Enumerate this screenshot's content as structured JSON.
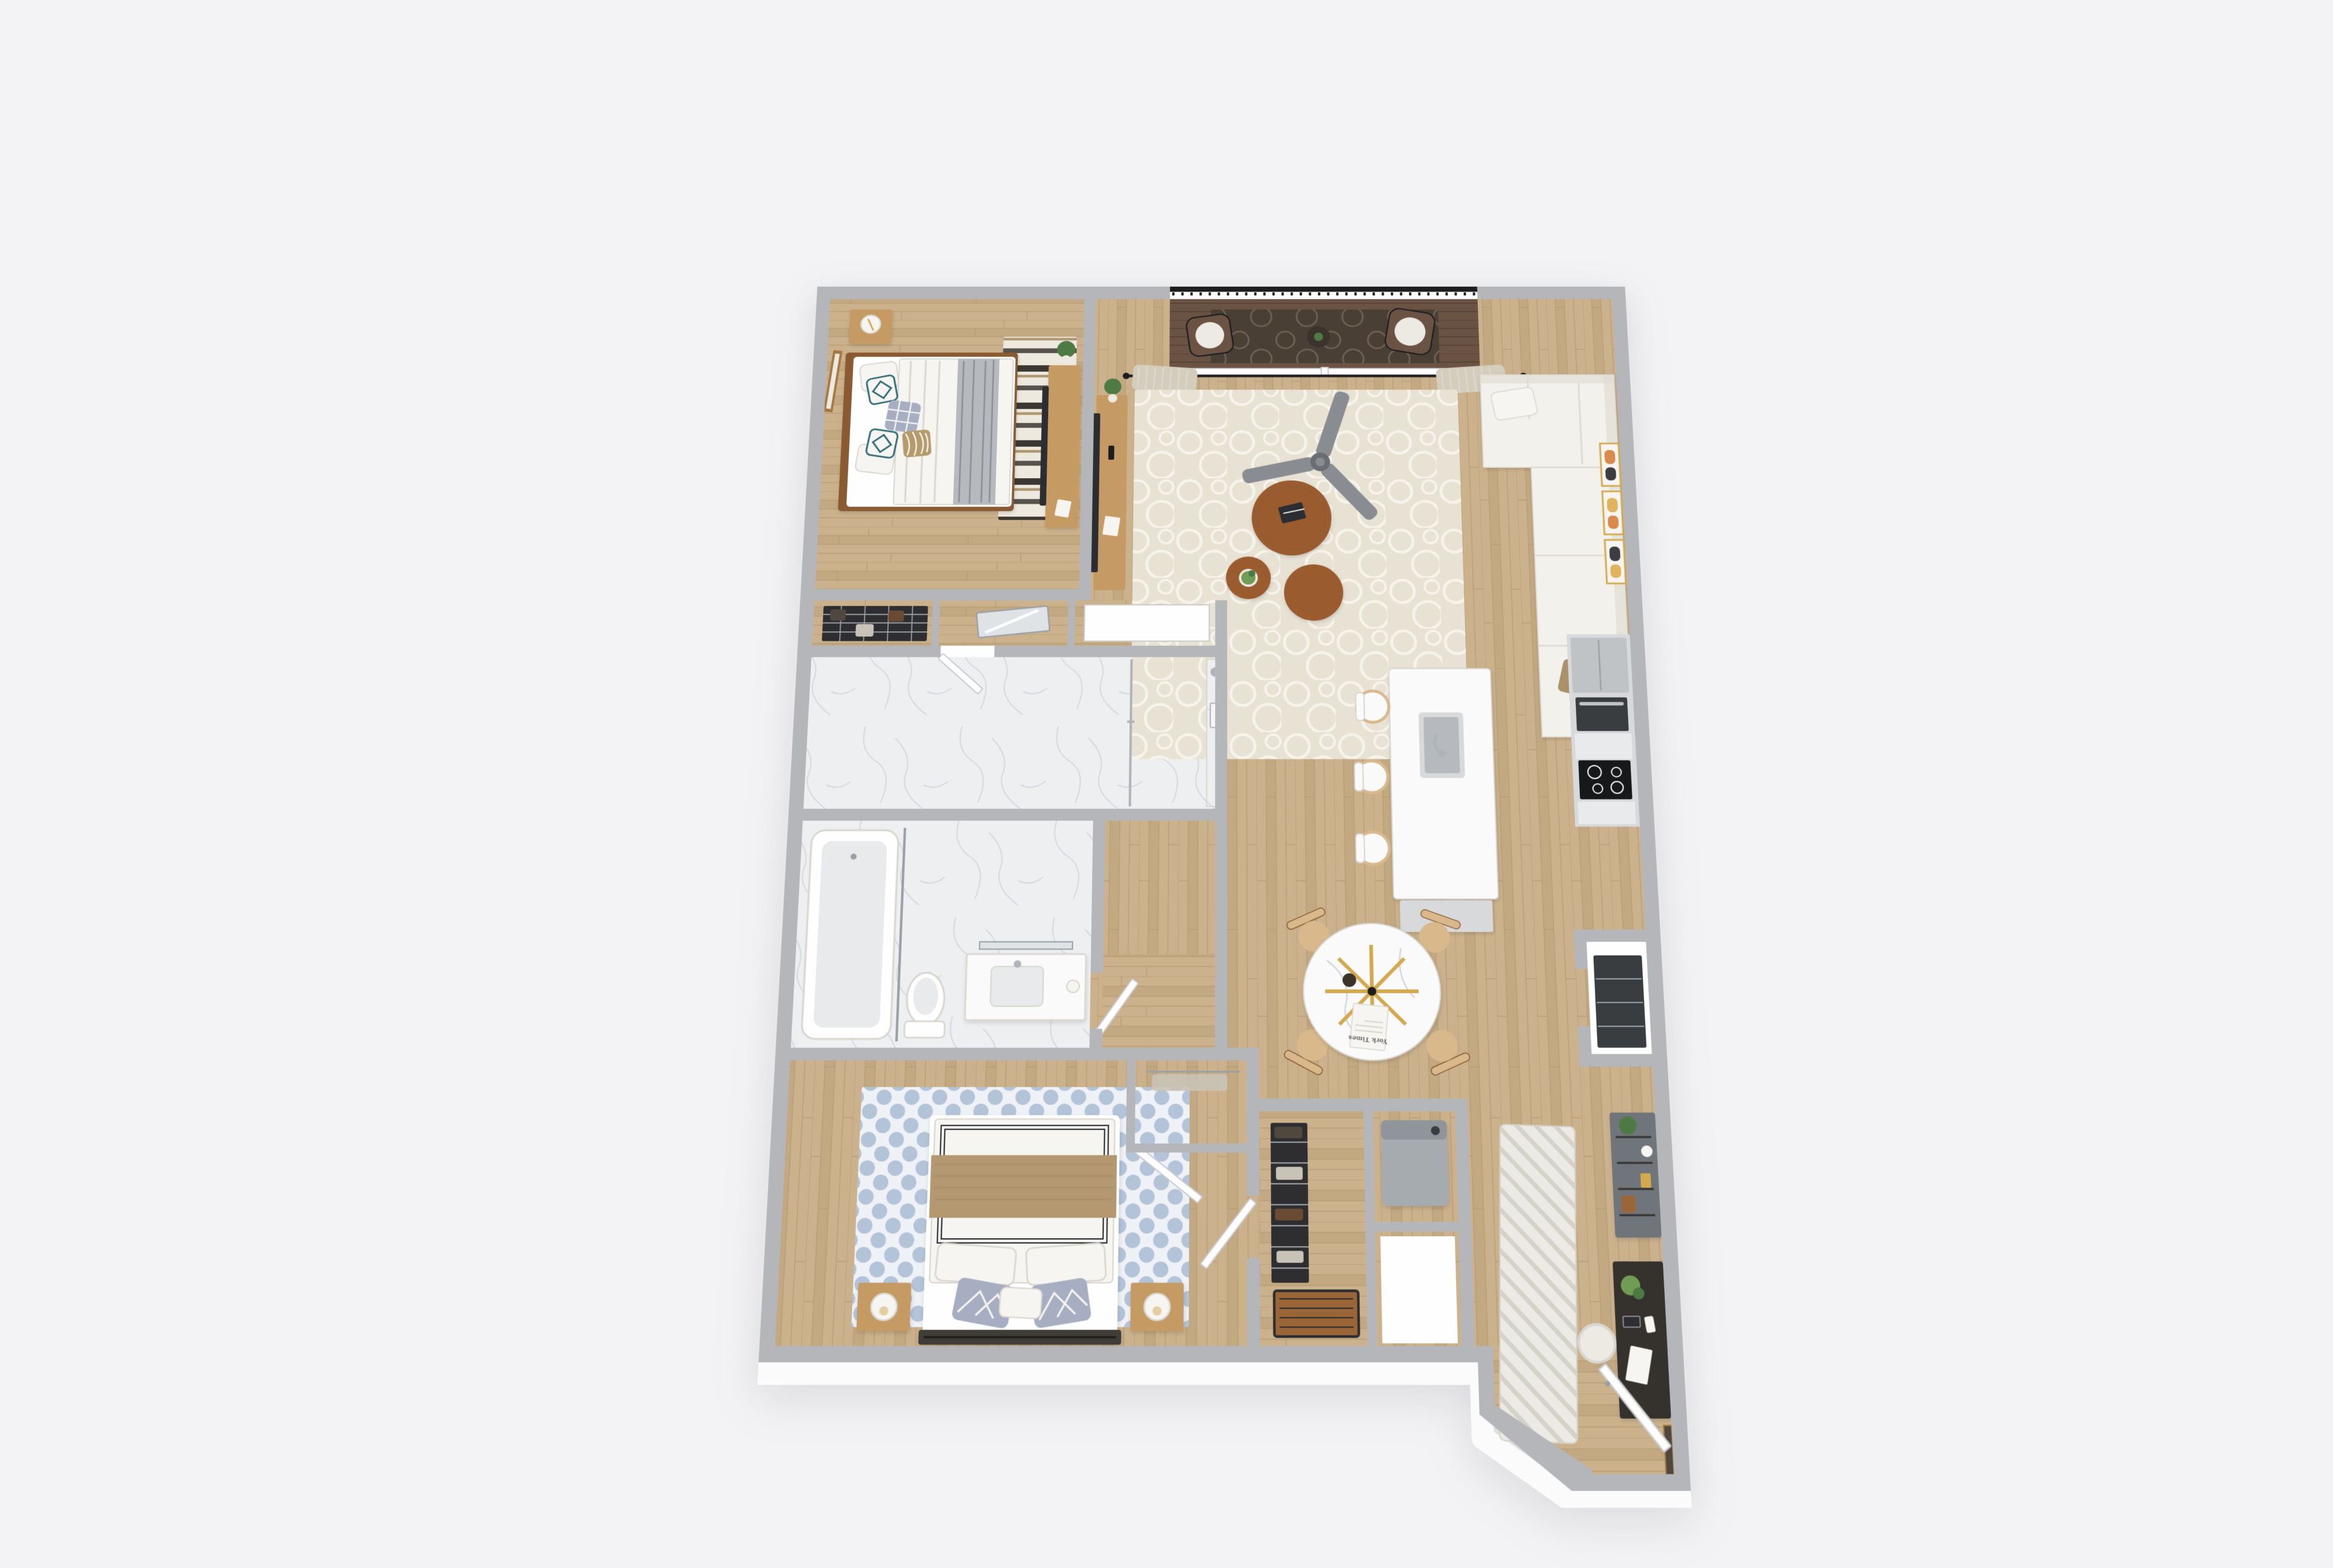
{
  "scene": {
    "title": "3d-apartment-floor-plan-render",
    "view": "top-down 3d dollhouse render, two-bedroom apartment, no visible UI text",
    "background": "plain light-gray studio backdrop"
  },
  "palette": {
    "pageBg": "#f3f3f5",
    "wallTop": "#b5b6b9",
    "wallFace": "#fbfbfc",
    "roomWhite": "#fefefe",
    "woodBase": "#cbb28d",
    "woodLine": "#b79e78",
    "woodAlt": "#c3a982",
    "deck": "#6b5344",
    "deckLine": "#564336",
    "deckRug": "#4a3f35",
    "deckRugSwirl": "#6e6154",
    "marble": "#edeff1",
    "marbleVein": "#d3d7db",
    "rugCream": "#e7e2d4",
    "rugCreamPattern": "#f6f3ea",
    "rugB1": "#eee9df",
    "rugB1Dark": "#3b3833",
    "rugB1Tan": "#b09873",
    "rugB2": "#eef1f5",
    "rugB2Dot": "#a9bcd4",
    "runner": "#eceae4",
    "runnerStripe": "#d5d2ca",
    "sofa": "#f3f1ec",
    "sofaShade": "#dedbd2",
    "cushionTan": "#ab916b",
    "pillowTeal": "#2e6d72",
    "pillowPlaid": "#a7aec2",
    "pillowTan": "#b59a6b",
    "throwGray": "#b6b9bd",
    "throwTan": "#b3986f",
    "curtain": "#d3cdbb",
    "fanGray": "#898d92",
    "fanHub": "#6a6e73",
    "woodMid": "#c59a64",
    "woodDark": "#8a5a33",
    "walnut": "#9a5c2f",
    "chairWood": "#d9b98c",
    "headboard2": "#403c38",
    "black": "#1d1d1f",
    "tvDark": "#2b2d30",
    "steel": "#c0c3c6",
    "steelDark": "#9aa0a6",
    "chrome": "#aeb4ba",
    "cabGray": "#d8d9db",
    "cabWhite": "#fafafa",
    "counter": "#e9eaec",
    "cooktop": "#17181a",
    "ovenDark": "#3a3d40",
    "applianceGray": "#a6abb0",
    "applianceTop": "#8f959a",
    "hutchGray": "#70757b",
    "deskDark": "#35322e",
    "rackDark": "#2e2e30",
    "clothA": "#50483f",
    "clothB": "#c9c2b6",
    "clothC": "#6b4a33",
    "benchWood": "#9a6637",
    "plantGreen": "#4e7a43",
    "plantLight": "#6f9c55",
    "potDark": "#3b332c",
    "potWhite": "#eceae2",
    "gold": "#d4a94e",
    "lampWhite": "#f6f5f2",
    "doorWhite": "#fdfdfe",
    "doorEdge": "#c9c9cc",
    "frameBrown": "#a5773f",
    "artOrange": "#d98a4d",
    "artDark": "#3c3d42",
    "artYellow": "#e0b35c",
    "glassMirror": "#dfe3e6",
    "shadowSoft": "#d9d6cf",
    "textGray": "#6a6a6e"
  },
  "dining": {
    "newspaper_masthead": "York Times",
    "table": "round-marble-table",
    "centerpiece": "gold-starburst",
    "chairs": 4
  },
  "rooms": [
    {
      "name": "bedroom-1",
      "position": "north-west",
      "furniture": [
        "queen-bed",
        "teal-diamond-pillows",
        "plaid-pillow",
        "tan-stripe-pillow",
        "gray-throw",
        "nightstand",
        "drum-lamp",
        "wall-art-frame",
        "striped-area-rug",
        "tv-dresser",
        "bedroom-tv",
        "window-north",
        "plant"
      ]
    },
    {
      "name": "living-room",
      "position": "north-east",
      "furniture": [
        "balcony-deck",
        "balcony-railing",
        "wicker-chair-left",
        "wicker-chair-right",
        "balcony-table",
        "outdoor-rug",
        "sliding-door",
        "curtain-rod",
        "curtains",
        "ceiling-fan",
        "sectional-sofa",
        "tan-pillows",
        "nesting-coffee-tables",
        "table-plant",
        "book",
        "cream-rug",
        "media-console",
        "living-tv",
        "gallery-frames"
      ]
    },
    {
      "name": "kitchen",
      "position": "east",
      "furniture": [
        "cabinet-run",
        "refrigerator",
        "wall-oven",
        "cooktop",
        "island",
        "island-sink",
        "faucet",
        "bar-stools",
        "island-base-cabinet",
        "pantry",
        "pantry-shelves"
      ]
    },
    {
      "name": "dining-area",
      "position": "center-east",
      "furniture": [
        "round-marble-table",
        "gold-starburst",
        "newspaper",
        "vase",
        "dining-chairs"
      ]
    },
    {
      "name": "hall-closets",
      "position": "center-west",
      "furniture": [
        "wire-shelf-closet",
        "hanging-clothes",
        "mirror-closet",
        "linen-closet"
      ]
    },
    {
      "name": "bathroom-1",
      "position": "west-middle",
      "furniture": [
        "marble-floor",
        "walk-in-shower",
        "marble-shower-wall",
        "glass-panel",
        "shower-head",
        "shower-niche",
        "door"
      ]
    },
    {
      "name": "bathroom-2",
      "position": "west-lower",
      "furniture": [
        "bathtub",
        "shower-rod",
        "toilet",
        "vanity",
        "sink",
        "faucet",
        "door"
      ]
    },
    {
      "name": "bedroom-2",
      "position": "south-west",
      "furniture": [
        "queen-bed",
        "gray-diamond-pillows",
        "tan-throw",
        "headboard",
        "blue-dot-rug",
        "nightstand-left",
        "nightstand-right",
        "sphere-lamps",
        "window-west",
        "walk-in-closet",
        "closet-door",
        "entry-door-to-hall"
      ]
    },
    {
      "name": "utility-block",
      "position": "south-center",
      "furniture": [
        "walk-in-closet-racks",
        "storage-bench",
        "laundry-closet",
        "washer-dryer",
        "coat-closet"
      ]
    },
    {
      "name": "entry-hall",
      "position": "south-east",
      "furniture": [
        "striped-runner-rug",
        "console-hutch",
        "hutch-plant",
        "writing-desk",
        "desk-plant",
        "desk-papers",
        "desk-chair",
        "leaning-art",
        "entry-door",
        "entry-nook"
      ]
    }
  ]
}
